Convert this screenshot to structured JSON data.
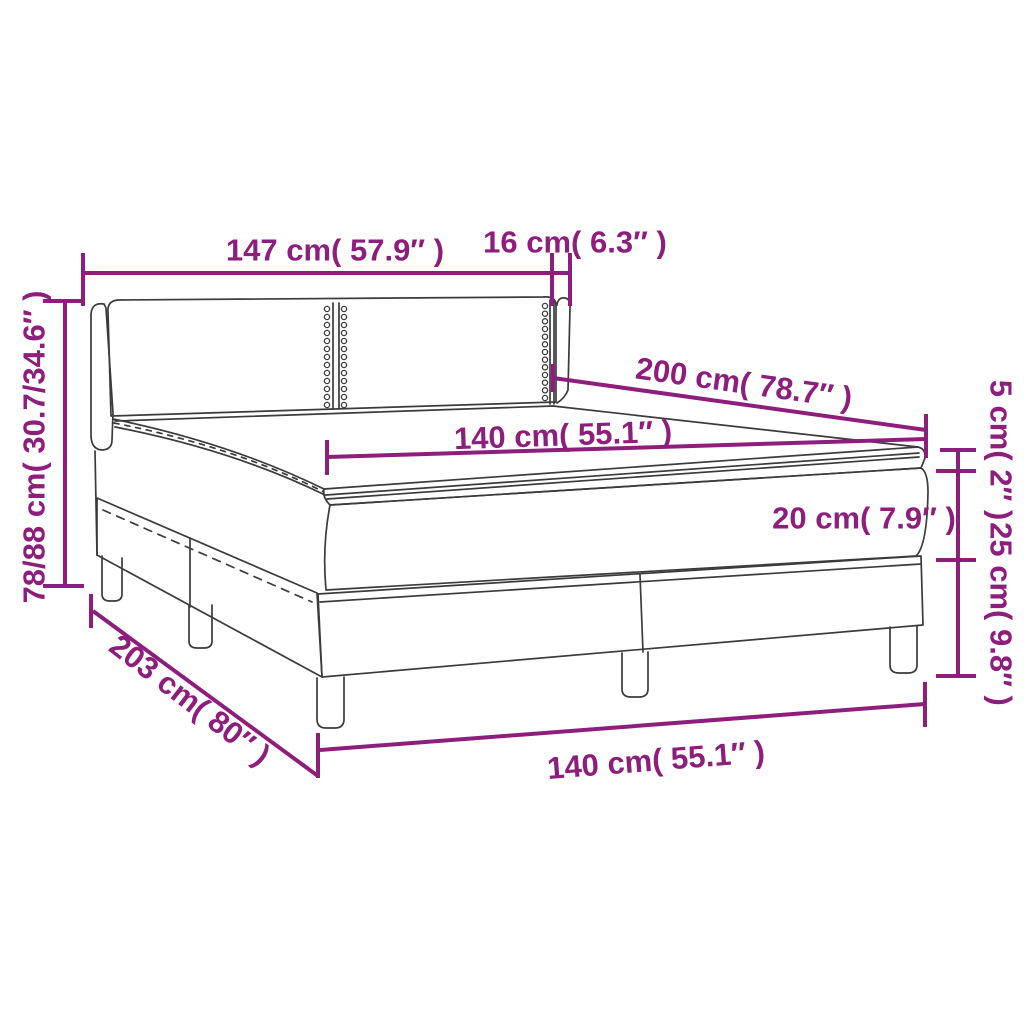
{
  "colors": {
    "dimension_accent": "#8e1e7c",
    "line_art": "#3b3b3b",
    "background": "#ffffff"
  },
  "labels": {
    "headboard_width": "147 cm( 57.9″ )",
    "headboard_wing_depth": "16 cm( 6.3″ )",
    "overall_height": "78/88 cm( 30.7/34.6″ )",
    "mattress_length": "200 cm( 78.7″ )",
    "mattress_width": "140 cm( 55.1″ )",
    "topper_height": "5 cm( 2″ )",
    "mattress_height": "20 cm( 7.9″ )",
    "base_height": "25 cm( 9.8″ )",
    "bed_length": "203 cm( 80″ )",
    "bed_width": "140 cm( 55.1″ )"
  }
}
